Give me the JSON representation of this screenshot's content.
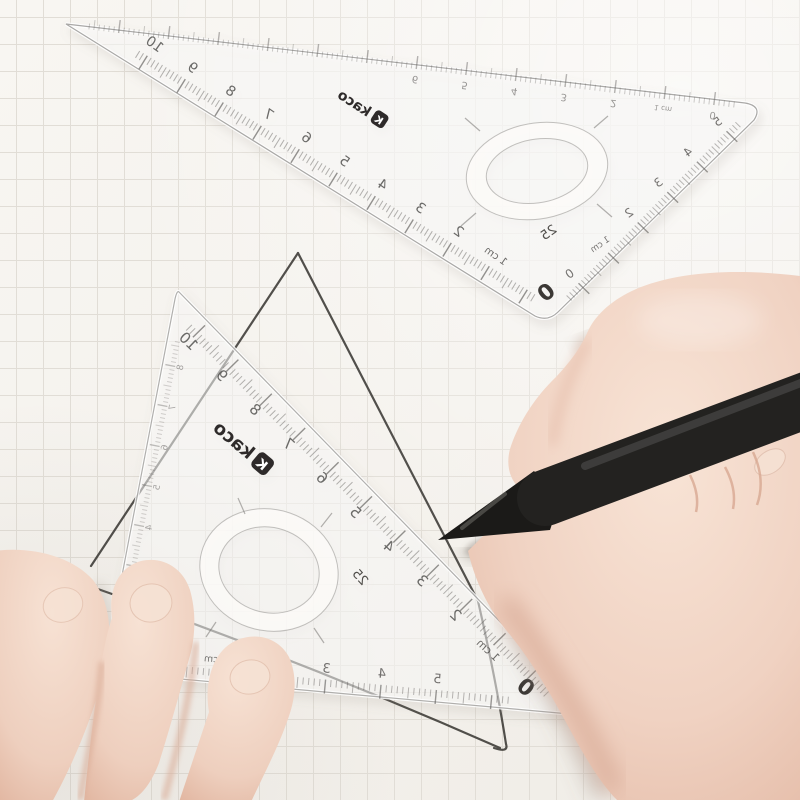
{
  "scene": {
    "subject": "Two transparent KACO triangular set squares on squared grid paper; a right hand draws a pencil line with a black pen while left-hand fingertips hold the lower set square"
  },
  "colors": {
    "paper": "#f5f2ed",
    "grid_line": "#e1ddd6",
    "pencil_line": "#3b3935",
    "ruler_edge": "#8f8d8a",
    "scale_ink": "#4a4846",
    "pen_black": "#232220",
    "skin": "#f0d4c5",
    "skin_shadow": "#d9ab97",
    "nail": "#f6e2d4",
    "paper_shadow": "#b9ac9f"
  },
  "top_ruler": {
    "brand": "kaco",
    "brand_mark": "K",
    "hole_label": "25",
    "corner_zero": "0",
    "long_edge_scale": [
      "10",
      "9",
      "8",
      "7",
      "6",
      "5",
      "4",
      "3",
      "2",
      "1 cm"
    ],
    "short_edge_scale": [
      "5",
      "4",
      "3",
      "2",
      "1 cm",
      "0"
    ],
    "top_edge_scale": [
      "0",
      "1 cm",
      "2",
      "3",
      "4",
      "5",
      "6"
    ]
  },
  "bottom_ruler": {
    "brand": "kaco",
    "brand_mark": "K",
    "hole_label": "25",
    "hypotenuse_zero": "0",
    "hypotenuse_scale": [
      "10",
      "9",
      "8",
      "7",
      "6",
      "5",
      "4",
      "3",
      "2",
      "1 cm"
    ],
    "bottom_edge_scale": [
      "0",
      "1 cm",
      "2",
      "3",
      "4",
      "5"
    ],
    "left_edge_scale": [
      "8",
      "7",
      "6",
      "5",
      "4",
      "3"
    ]
  }
}
